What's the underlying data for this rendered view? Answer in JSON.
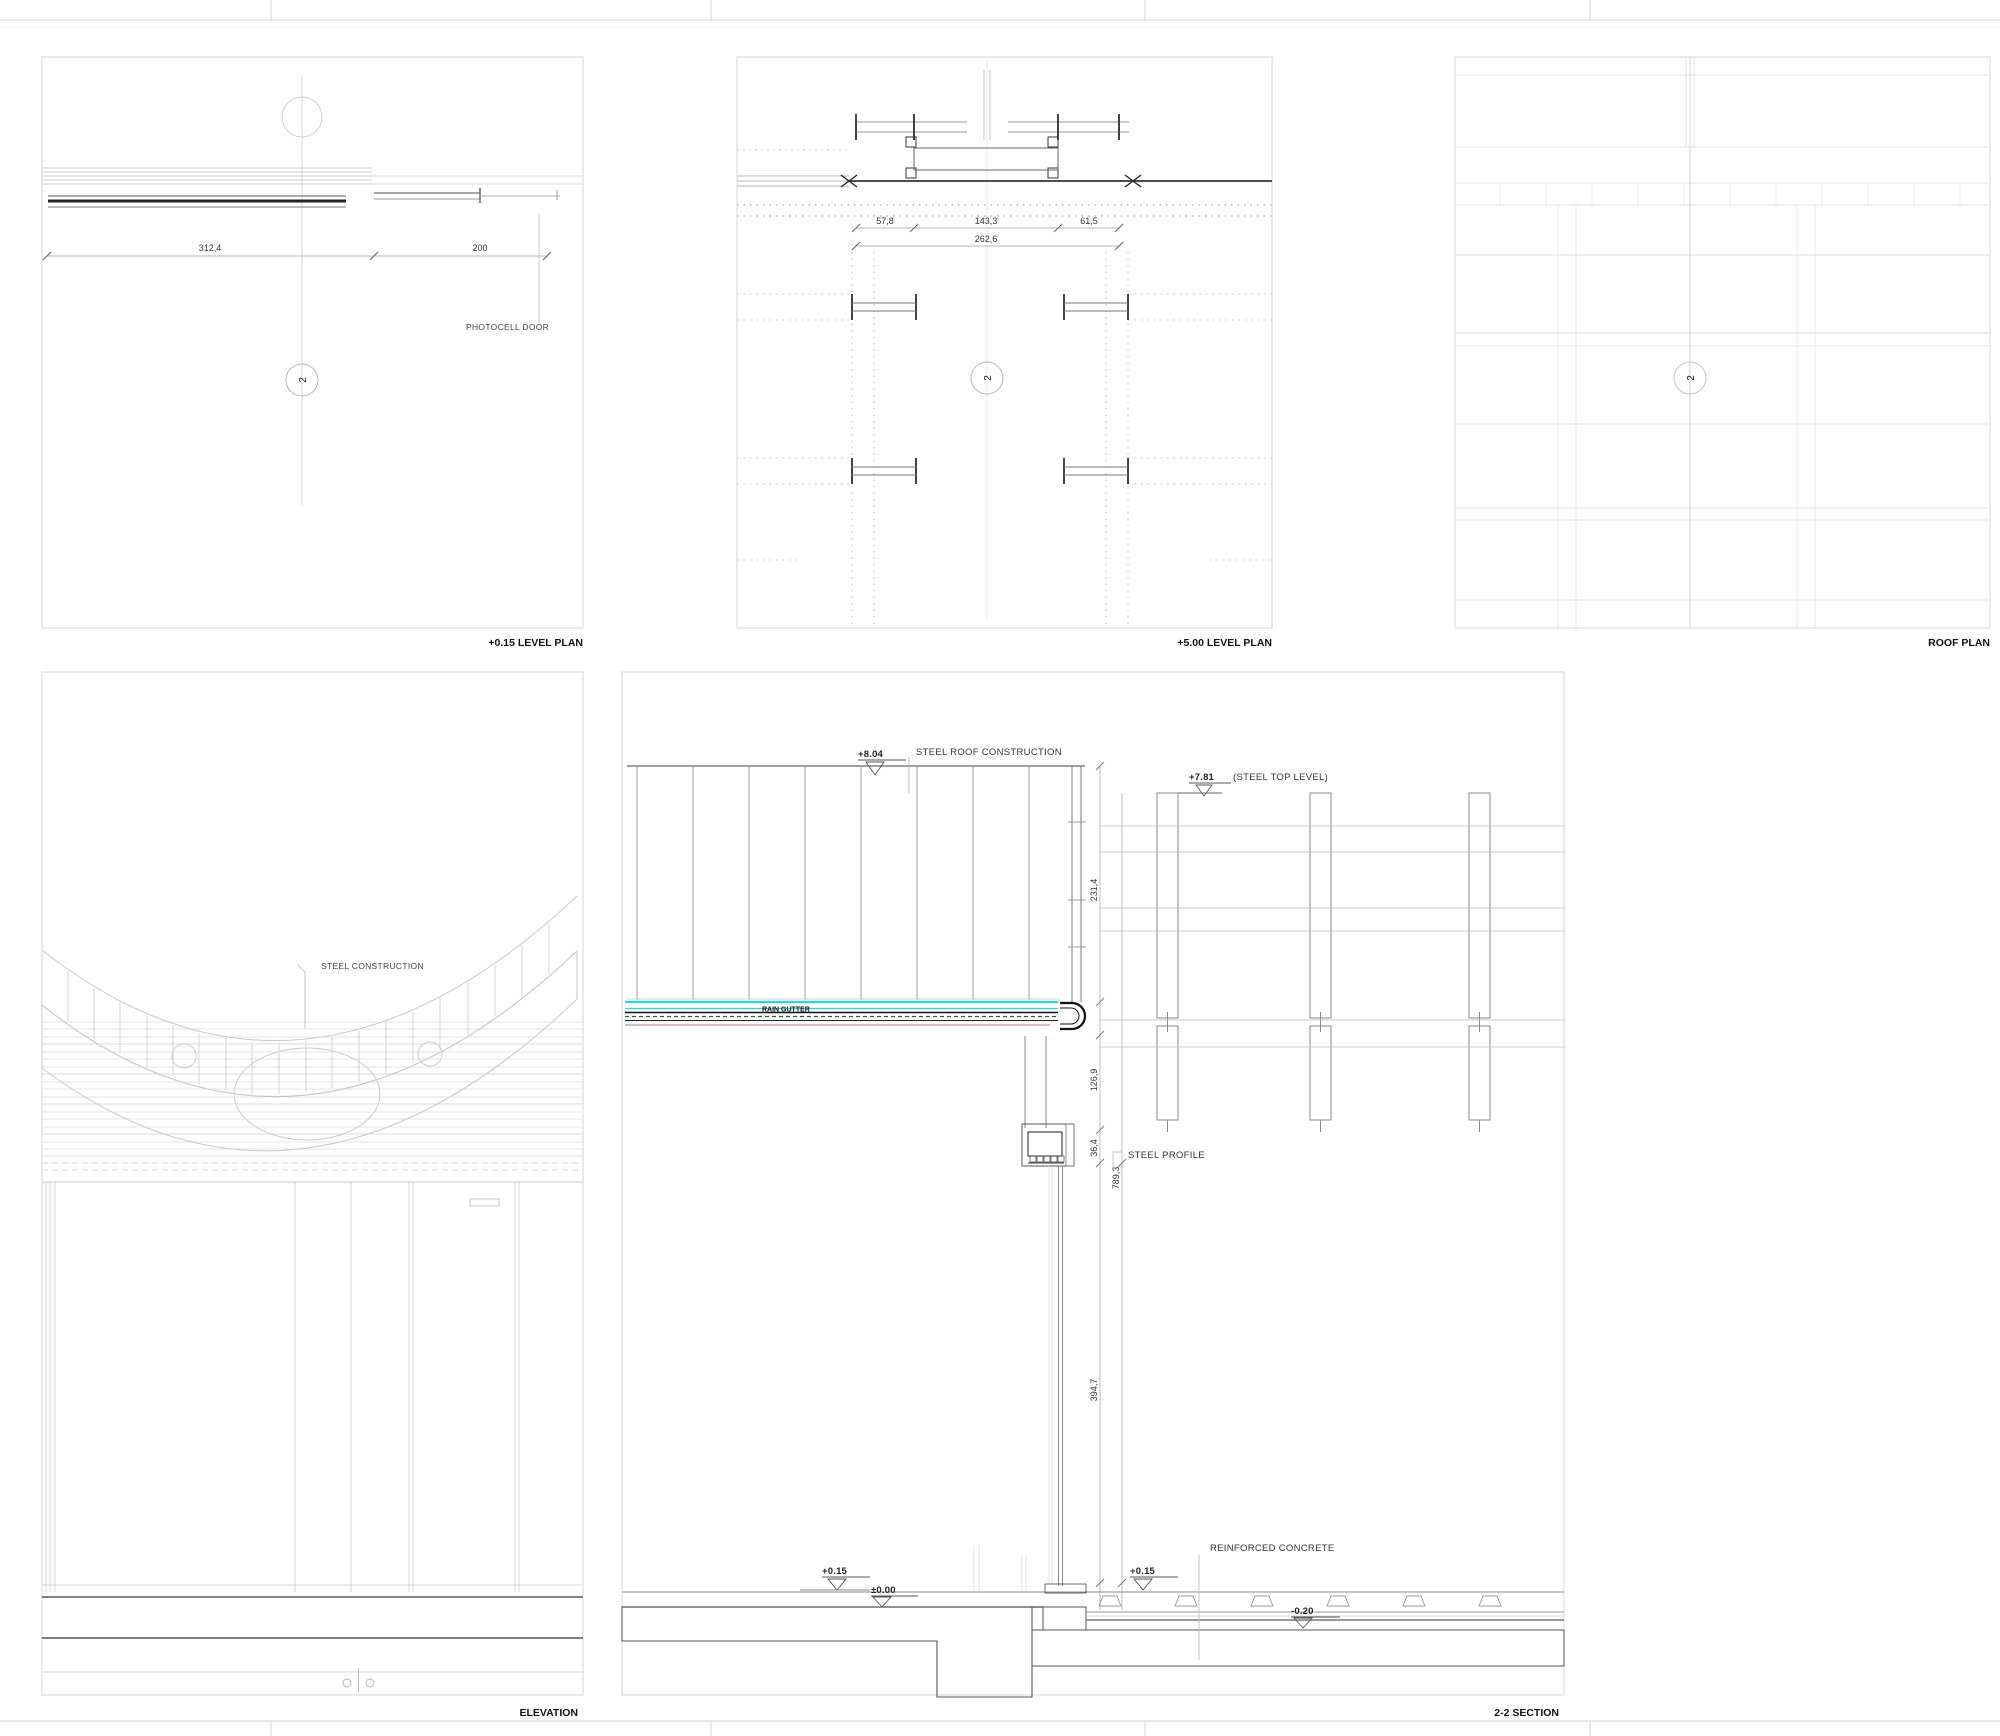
{
  "sheet": {
    "background": "#ffffff",
    "frame_color": "#d2d2d2"
  },
  "colors": {
    "gutter_cyan": "#1adfe0",
    "membrane_pink": "#cf9fb5",
    "dash_teal": "#2a5a4a",
    "cut_dark": "#1a1a1a",
    "light_gray": "#d5d5d5"
  },
  "panels": {
    "level_plan_015": {
      "title": "+0.15 LEVEL PLAN",
      "dim_left": "312,4",
      "dim_right": "200",
      "photocell_door": "PHOTOCELL DOOR",
      "section_marker": "2"
    },
    "level_plan_500": {
      "title": "+5.00 LEVEL PLAN",
      "dim_1": "57,8",
      "dim_2": "143,3",
      "dim_3": "61,5",
      "dim_total": "262,6",
      "section_marker": "2"
    },
    "roof_plan": {
      "title": "ROOF PLAN",
      "section_marker": "2"
    },
    "elevation": {
      "title": "ELEVATION",
      "steel_construction": "STEEL CONSTRUCTION"
    },
    "section": {
      "title": "2-2 SECTION",
      "labels": {
        "steel_roof": "STEEL ROOF CONSTRUCTION",
        "rain_gutter": "RAIN GUTTER",
        "steel_profile": "STEEL PROFILE",
        "reinforced_concrete": "REINFORCED CONCRETE"
      },
      "levels": {
        "roof_top": "+8.04",
        "steel_top": "+7.81",
        "steel_top_suffix": "(STEEL TOP LEVEL)",
        "floor_plus15_left": "+0.15",
        "floor_zero": "±0.00",
        "floor_plus15_right": "+0.15",
        "floor_minus20": "-0.20"
      },
      "dims": {
        "d1": "231,4",
        "d2": "126,9",
        "d3": "36,4",
        "d4": "789,3",
        "d5": "394,7"
      }
    }
  }
}
